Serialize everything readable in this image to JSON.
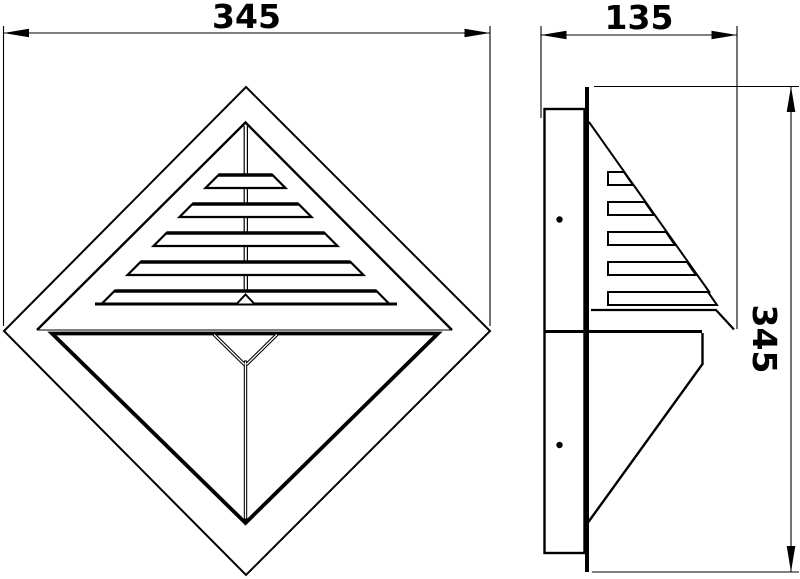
{
  "canvas": {
    "background": "#ffffff",
    "line_color": "#000000"
  },
  "dimensions": {
    "front_width": {
      "value": "345"
    },
    "side_depth": {
      "value": "135"
    },
    "side_height": {
      "value": "345"
    }
  },
  "front_view": {
    "shape": "diamond",
    "louver_count": 5
  },
  "side_view": {
    "louver_count": 5,
    "mounting_hole_count": 2
  }
}
